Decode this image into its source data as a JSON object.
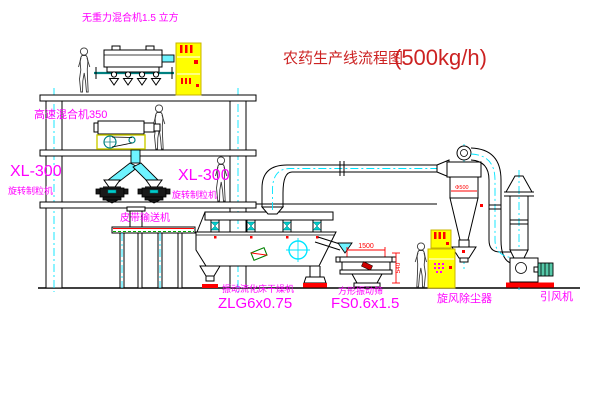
{
  "title": {
    "text": "农药生产线流程图",
    "capacity": "(500kg/h)"
  },
  "labels": {
    "top_mixer": "无重力混合机1.5 立方",
    "left_granulator_model": "XL-300",
    "left_granulator_name": "旋转制粒机",
    "high_speed_mixer": "高速混合机350",
    "mid_granulator_model": "XL-300",
    "mid_granulator_name": "旋转制粒机",
    "belt_conveyor": "皮带输送机",
    "dryer_name": "振动流化床干燥机",
    "dryer_model": "ZLG6x0.75",
    "screen_name": "方形振动筛",
    "screen_model": "FS0.6x1.5",
    "cyclone": "旋风除尘器",
    "fan": "引风机"
  },
  "dimensions": {
    "screen_length": "1500",
    "screen_height": "540",
    "cyclone_dia": "Φ500"
  },
  "colors": {
    "label_magenta": "#ff00ff",
    "title_red": "#cc2222",
    "cabinet_yellow": "#ffff00",
    "centerline_cyan": "#00e5ff",
    "pipe_teal": "#008080",
    "accent_red": "#ff0000",
    "belt_green": "#00aa00"
  }
}
